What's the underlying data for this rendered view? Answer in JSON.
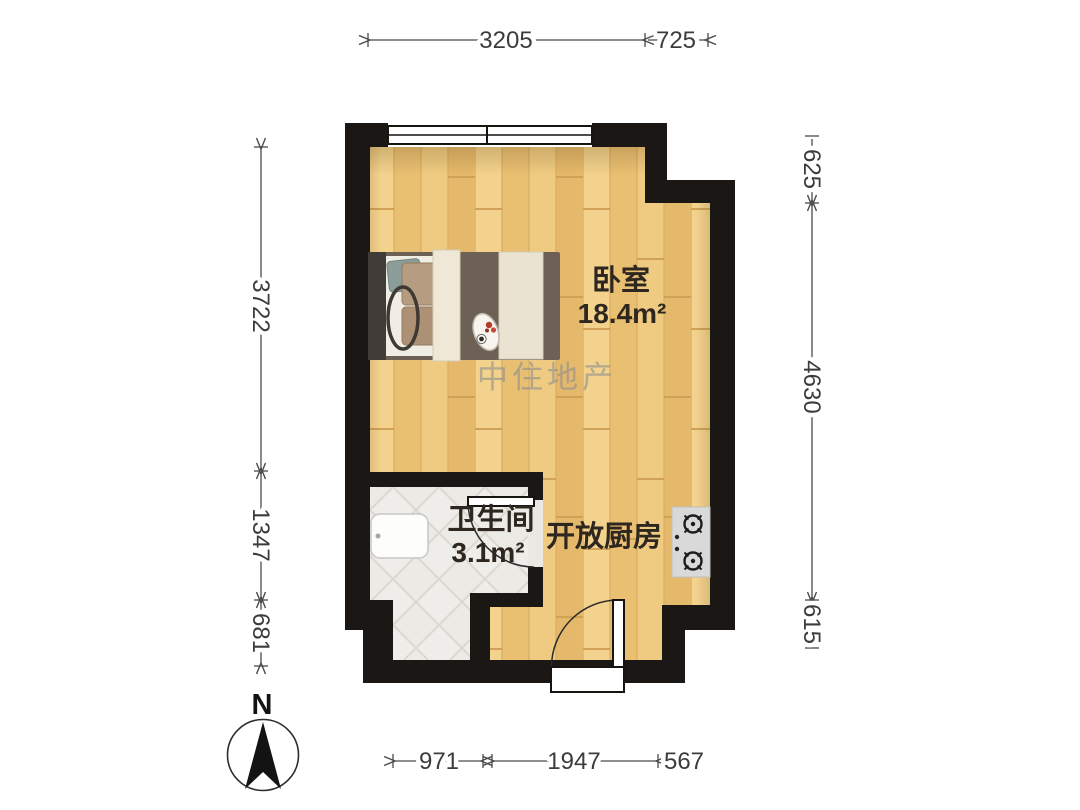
{
  "plan": {
    "watermark": "中住地产",
    "compass": {
      "label": "N"
    },
    "rooms": {
      "bedroom": {
        "name": "卧室",
        "area": "18.4m²"
      },
      "bathroom": {
        "name": "卫生间",
        "area": "3.1m²"
      },
      "kitchen": {
        "name": "开放厨房"
      }
    },
    "dimensions": {
      "top": [
        "3205",
        "725"
      ],
      "left": [
        "3722",
        "1347",
        "681"
      ],
      "right": [
        "625",
        "4630",
        "615"
      ],
      "bottom": [
        "971",
        "1947",
        "567"
      ]
    },
    "colors": {
      "wall": "#1a1714",
      "wood_floor": "#eec87d",
      "tile_floor": "#eceae5",
      "dimension_text": "#3c3c3c",
      "watermark_gray": "#8f8f8f"
    }
  }
}
